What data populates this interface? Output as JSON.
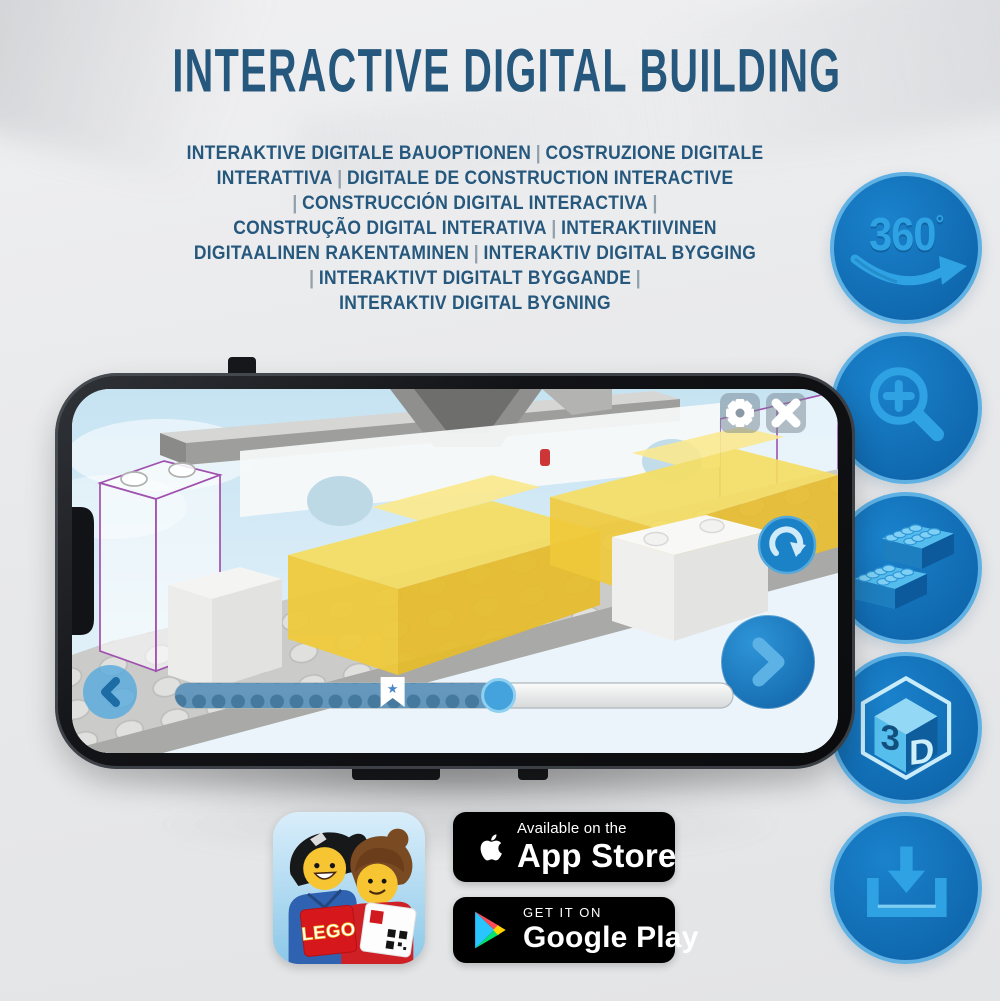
{
  "title": "INTERACTIVE DIGITAL BUILDING",
  "subtitle_lines": [
    "INTERAKTIVE DIGITALE BAUOPTIONEN | COSTRUZIONE DIGITALE",
    "INTERATTIVA | DIGITALE DE CONSTRUCTION INTERACTIVE",
    "| CONSTRUCCIÓN DIGITAL INTERACTIVA |",
    "CONSTRUÇÃO DIGITAL INTERATIVA | INTERAKTIIVINEN",
    "DIGITAALINEN RAKENTAMINEN | INTERAKTIV DIGITAL BYGGING",
    "| INTERAKTIVT DIGITALT BYGGANDE |",
    "INTERAKTIV DIGITAL BYGNING"
  ],
  "colors": {
    "title_blue": "#26587D",
    "badge_fill": "#1273BB",
    "badge_ring": "#5FB0E3",
    "badge_glyph": "#2EA2E2",
    "brick_yellow": "#F0CA39",
    "ghost_outline_purple": "#A050AE"
  },
  "feature_badges": [
    {
      "name": "360-rotation",
      "label": "360",
      "degree": "°"
    },
    {
      "name": "zoom-in"
    },
    {
      "name": "lego-brick"
    },
    {
      "name": "3d-view",
      "face_left": "3",
      "face_right": "D"
    },
    {
      "name": "download"
    }
  ],
  "phone": {
    "screen": {
      "controls": [
        "settings",
        "close",
        "rotate",
        "previous",
        "next"
      ],
      "progress": {
        "percent": 58,
        "bookmark_percent": 39,
        "star": "★"
      }
    }
  },
  "app_icon": {
    "logo_text": "LEGO"
  },
  "store_badges": {
    "app_store": {
      "line1": "Available on the",
      "line2": "App Store"
    },
    "google_play": {
      "line1": "GET IT ON",
      "line2": "Google Play"
    }
  }
}
